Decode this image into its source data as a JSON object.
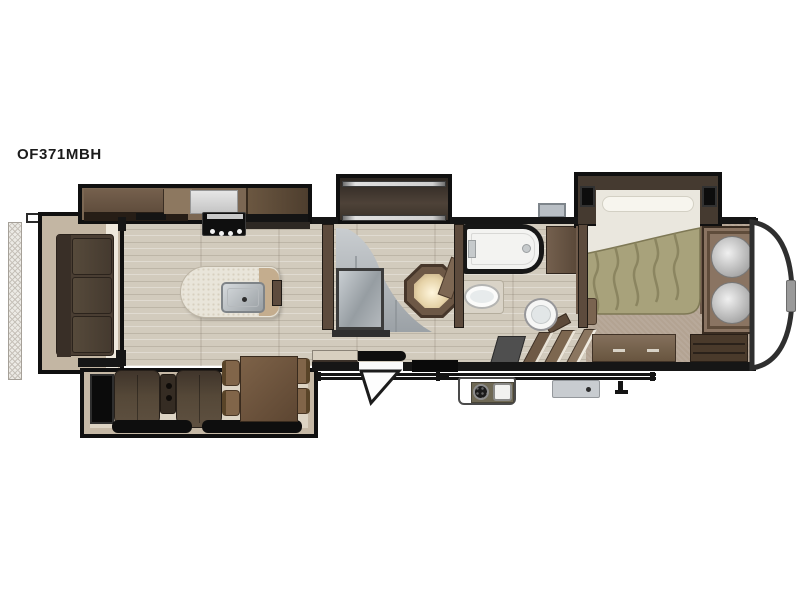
{
  "model_label": "OF371MBH",
  "floorplan": {
    "kind": "rv-fifth-wheel-floorplan",
    "orientation": "hitch-on-right",
    "colors": {
      "wall": "#161616",
      "wood_floor": "#d2cbbd",
      "carpet": "#b3a392",
      "cabinet_dark": "#5c4a3a",
      "cabinet_mid": "#7b6753",
      "sofa_brown": "#4a3e33",
      "island_top": "#e9e5da",
      "stainless": "#a9aeb2",
      "tub_white": "#f3f3f1",
      "mirror_gray": "#a9aeb2",
      "bedspread_green": "#a8a27b",
      "mat_black": "#0e0e0e",
      "slide_floor_tan": "#c6b9a6",
      "outdoor_box_gray": "#c8ccd0"
    },
    "features": {
      "rear_porch": "rear-porch-hatch",
      "rear_slide": "rear-sofa-slide-out",
      "sofa": "three-cushion-sofa",
      "kitchen_slide": "kitchen-appliance-slide-out",
      "entertainment": "entertainment-cabinet",
      "microwave": "microwave-oven",
      "range": "range-cooktop",
      "refrigerator": "refrigerator",
      "island": "kitchen-island-with-sink",
      "living_slide": "theater-dinette-slide-out",
      "fireplace": "electric-fireplace",
      "theater_seats": "theater-seating-pair",
      "dinette": "free-standing-dinette-with-four-chairs",
      "bunk_slide": "mid-bunk-slide-out",
      "bunk_wardrobe": "mirrored-sliding-wardrobe",
      "bunk_desk": "corner-desk-with-lamp",
      "bath_tub": "tub-shower",
      "bath_sink": "bathroom-sink",
      "toilet": "toilet",
      "linen": "linen-cabinet",
      "stairs": "steps-to-bedroom",
      "bed": "queen-bed-slide-out",
      "front_wardrobe": "front-wardrobe-closet",
      "dresser": "bedroom-dresser",
      "awning": "patio-awning",
      "outdoor_kitchen": "exterior-kitchen-griddle-sink",
      "utility_box": "utility-hookup-box",
      "entry_step": "entry-door-step",
      "front_cap": "front-cap-nose"
    }
  }
}
